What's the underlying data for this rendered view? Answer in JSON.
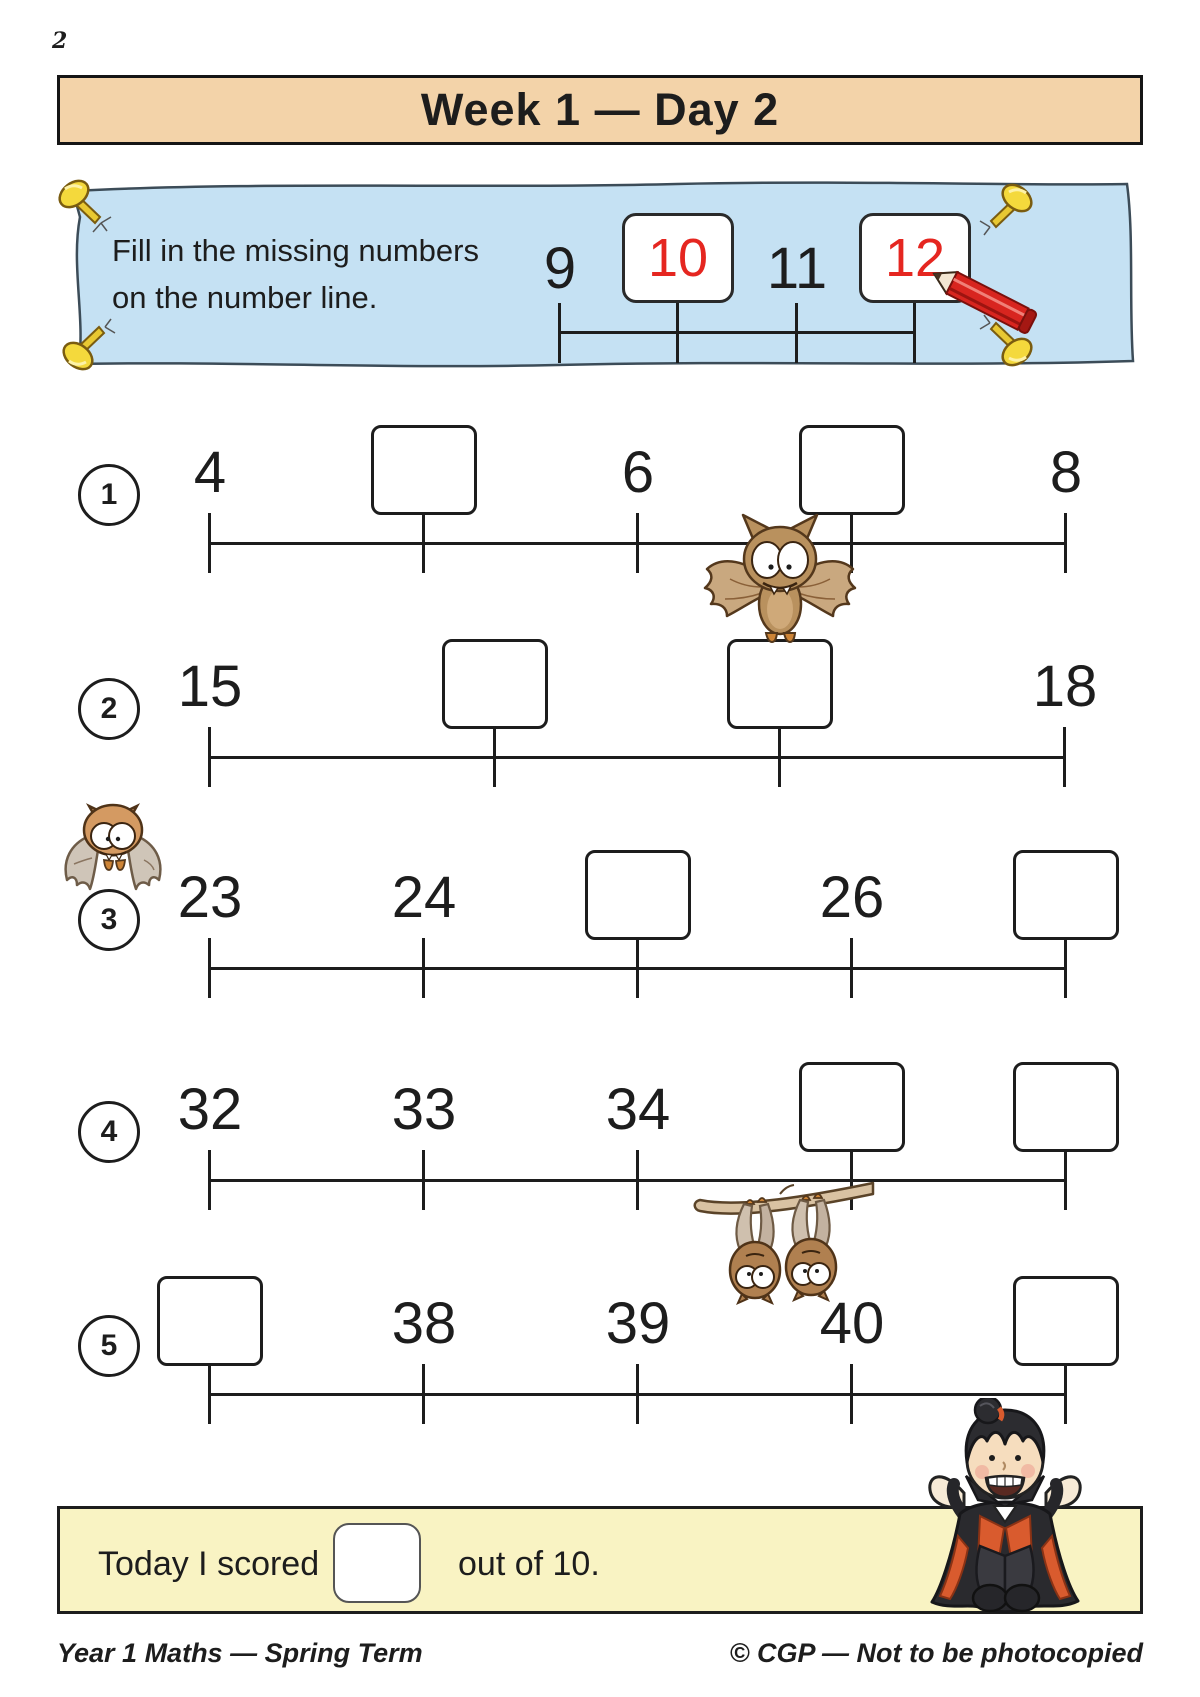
{
  "page": {
    "number": "2"
  },
  "header": {
    "title": "Week 1 — Day 2"
  },
  "instruction_banner": {
    "line1": "Fill in the missing numbers",
    "line2": "on the number line.",
    "example": {
      "slots": [
        {
          "type": "number",
          "label": "9"
        },
        {
          "type": "answer",
          "label": "10"
        },
        {
          "type": "number",
          "label": "11"
        },
        {
          "type": "answer",
          "label": "12"
        }
      ]
    }
  },
  "questions": [
    {
      "number": "1",
      "slots": [
        {
          "type": "number",
          "label": "4"
        },
        {
          "type": "box"
        },
        {
          "type": "number",
          "label": "6"
        },
        {
          "type": "box"
        },
        {
          "type": "number",
          "label": "8"
        }
      ]
    },
    {
      "number": "2",
      "slots": [
        {
          "type": "number",
          "label": "15"
        },
        {
          "type": "box"
        },
        {
          "type": "box"
        },
        {
          "type": "number",
          "label": "18"
        }
      ]
    },
    {
      "number": "3",
      "slots": [
        {
          "type": "number",
          "label": "23"
        },
        {
          "type": "number",
          "label": "24"
        },
        {
          "type": "box"
        },
        {
          "type": "number",
          "label": "26"
        },
        {
          "type": "box"
        }
      ]
    },
    {
      "number": "4",
      "slots": [
        {
          "type": "number",
          "label": "32"
        },
        {
          "type": "number",
          "label": "33"
        },
        {
          "type": "number",
          "label": "34"
        },
        {
          "type": "box"
        },
        {
          "type": "box"
        }
      ]
    },
    {
      "number": "5",
      "slots": [
        {
          "type": "box"
        },
        {
          "type": "number",
          "label": "38"
        },
        {
          "type": "number",
          "label": "39"
        },
        {
          "type": "number",
          "label": "40"
        },
        {
          "type": "box"
        }
      ]
    }
  ],
  "score_banner": {
    "prefix": "Today I scored",
    "suffix": "out of 10."
  },
  "footer": {
    "left": "Year 1 Maths — Spring Term",
    "right": "© CGP — Not to be photocopied"
  },
  "colors": {
    "header_bg": "#f3d3a9",
    "instruction_bg": "#c5e1f3",
    "score_bg": "#f9f3c3",
    "answer_red": "#e52620",
    "line_black": "#1d1d1d"
  }
}
